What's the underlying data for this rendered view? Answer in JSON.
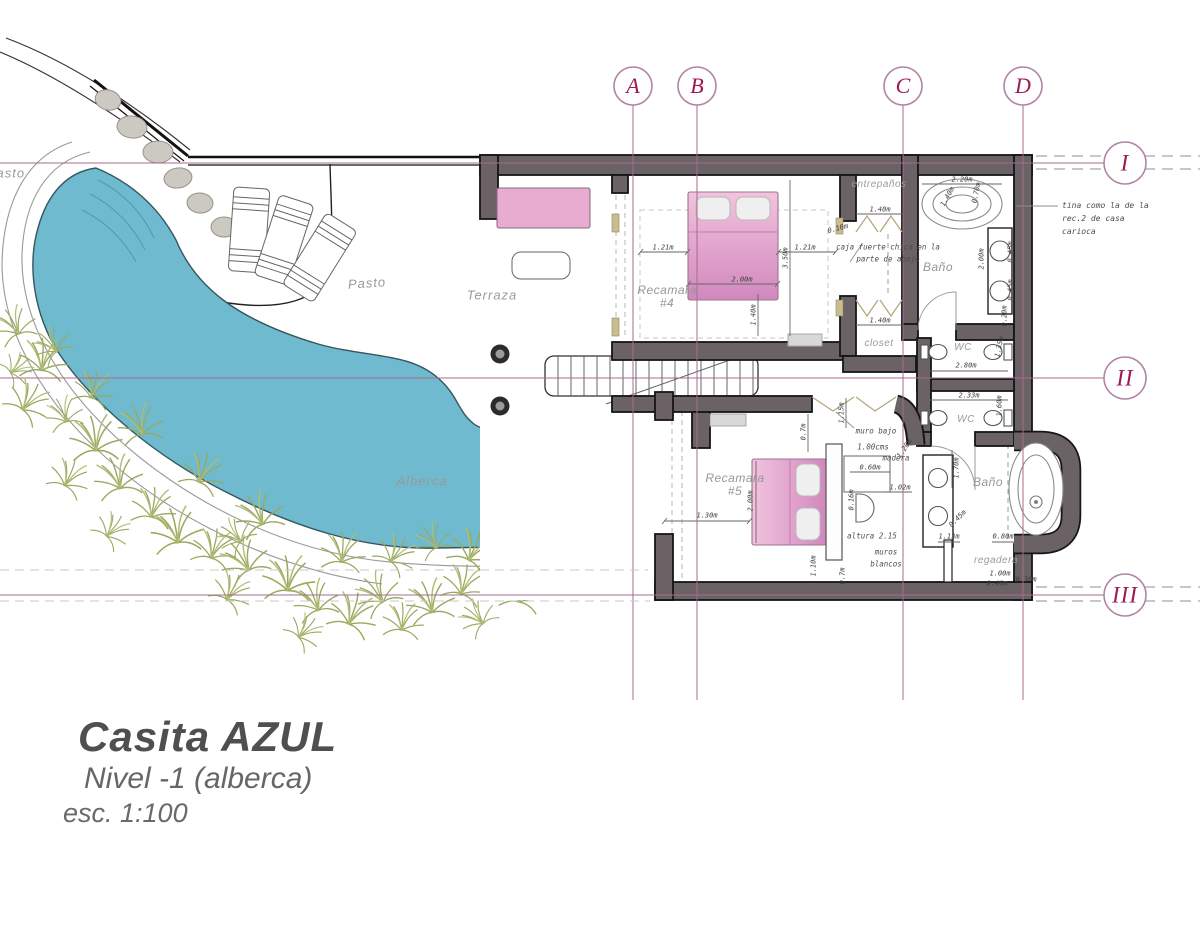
{
  "title_block": {
    "project": "Casita AZUL",
    "level": "Nivel -1 (alberca)",
    "scale": "esc. 1:100"
  },
  "grid": {
    "columns": [
      {
        "label": "A"
      },
      {
        "label": "B"
      },
      {
        "label": "C"
      },
      {
        "label": "D"
      }
    ],
    "rows": [
      {
        "label": "I"
      },
      {
        "label": "II"
      },
      {
        "label": "III"
      }
    ]
  },
  "site": {
    "pasto": "Pasto",
    "pasto_left": "Pasto",
    "terraza": "Terraza",
    "alberca": "Alberca"
  },
  "rooms": {
    "recamara4_name": "Recamara",
    "recamara4_num": "#4",
    "recamara5_name": "Recamara",
    "recamara5_num": "#5",
    "bano_norte": "Baño",
    "bano_sur": "Baño",
    "wc_norte": "WC",
    "wc_sur": "WC",
    "closet": "closet",
    "entrepanos": "entrepaños",
    "regadera": "regadera"
  },
  "notes": {
    "tina_1": "tina como la de la",
    "tina_2": "rec.2 de casa",
    "tina_3": "carioca",
    "caja_1": "caja fuerte chica en la",
    "caja_2": "parte de abajo",
    "muro_1": "muro bajo",
    "muro_2": "1.00cms",
    "muro_3": "madera",
    "altura_1": "altura 2.15",
    "altura_2": "muros",
    "altura_3": "blancos"
  },
  "dims": {
    "rec4_left": "1.21m",
    "rec4_bed": "2.00m",
    "rec4_right": "1.21m",
    "rec4_depth": "3.50m",
    "rec4_inner": "1.40m",
    "shelf_depth": "0.10m",
    "entrepanos_w": "1.40m",
    "closet_w": "1.40m",
    "tub_n_w": "2.20m",
    "tub_n_a": "1.40m",
    "tub_n_b": "0.70m",
    "bano_n_len": "2.00m",
    "vanity_n_1": "0.45m",
    "vanity_n_2": "0.45m",
    "vanity_n_3": "0.20m",
    "wc_n_fix": "1.35m",
    "wc_n_w": "2.80m",
    "wc_s_w": "2.33m",
    "wc_s_fix": "1.60m",
    "rec5_left": "1.30m",
    "rec5_bed": "2.00m",
    "rec5_gap": "0.7m",
    "rec5_door": "1.15m",
    "desk_w": "0.60m",
    "desk_gap": "0.16m",
    "desk_side": "1.02m",
    "madera_h": "1.20m",
    "rec5_b1": "1.10m",
    "rec5_b2": "0.7m",
    "bano_s_len": "1.70m",
    "bano_s_diag": "0.45m",
    "bano_s_w1": "1.13m",
    "bano_s_w2": "0.80m",
    "shower_w": "1.00m",
    "shower_w2": "0.40m",
    "shower_d": "0.30m"
  },
  "colors": {
    "pool": "#6fbace",
    "wall": "#6b6266",
    "grid_line": "#a86a8e",
    "grid_text": "#9e1a52",
    "bed": "#dd96c5",
    "vegetation": "#9aa95f",
    "title": "#4f4f4f"
  }
}
